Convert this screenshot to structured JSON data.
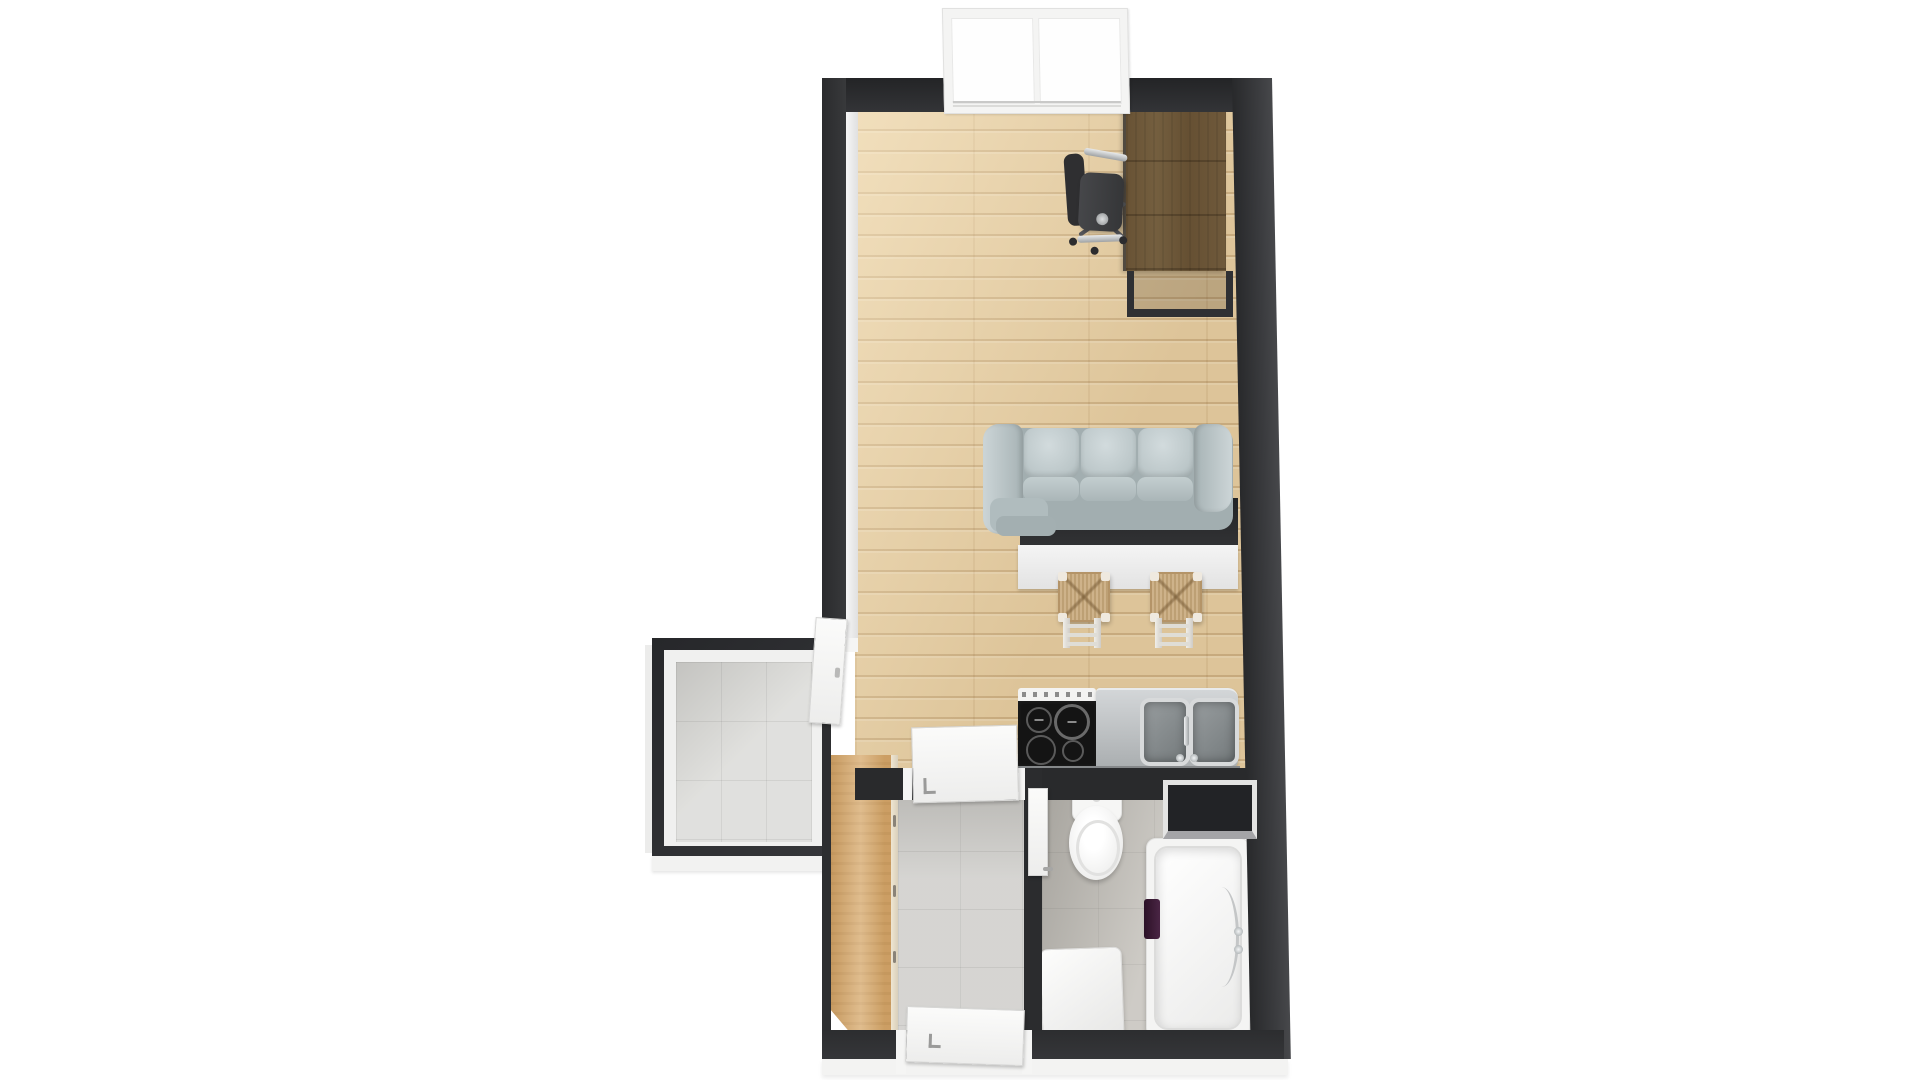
{
  "scene": {
    "type": "3d-floor-plan-render",
    "view": "top-down",
    "background": "#ffffff",
    "colors": {
      "wall": "#2e2f31",
      "wood-floor": "#e6cc9f",
      "tile-balcony": "#dcdcd9",
      "tile-hall": "#d2d1ce",
      "tile-bath": "#c8c5bf",
      "wood-desk": "#a69478",
      "wood-wardrobe": "#d7aa6e",
      "wood-stool": "#c7a87a",
      "sofa": "#bcc7c9",
      "steel": "#b7babc",
      "cooktop": "#141414",
      "fixture-white": "#f6f6f5",
      "accent-purple": "#4a2544",
      "chrome": "#cdd0d2"
    },
    "rooms": [
      {
        "id": "living-room",
        "floor": "light-oak-planks"
      },
      {
        "id": "kitchenette",
        "floor": "light-oak-planks"
      },
      {
        "id": "balcony-storage-room",
        "floor": "light-gray-tile"
      },
      {
        "id": "hallway",
        "floor": "gray-tile"
      },
      {
        "id": "bathroom",
        "floor": "beige-gray-tile"
      }
    ],
    "furniture": [
      {
        "id": "window",
        "room": "living-room",
        "style": "white-frame-two-panes"
      },
      {
        "id": "desk",
        "room": "living-room",
        "material": "rustic-wood-metal-frame"
      },
      {
        "id": "office-chair",
        "room": "living-room",
        "style": "dark-swivel-chrome-arms"
      },
      {
        "id": "sofa",
        "room": "living-room",
        "seats": 3,
        "color": "light-blue-gray"
      },
      {
        "id": "breakfast-bar",
        "room": "kitchenette",
        "top": "dark",
        "base": "white"
      },
      {
        "id": "bar-stool",
        "count": 2,
        "seat": "woven-rush",
        "legs": "white"
      },
      {
        "id": "stove",
        "room": "kitchenette",
        "burners": 4
      },
      {
        "id": "double-sink",
        "room": "kitchenette",
        "material": "stainless-steel"
      },
      {
        "id": "wardrobe",
        "room": "hallway",
        "material": "light-wood"
      },
      {
        "id": "toilet",
        "room": "bathroom"
      },
      {
        "id": "bathtub",
        "room": "bathroom",
        "accessory": "purple-towel"
      },
      {
        "id": "washing-machine",
        "room": "bathroom"
      },
      {
        "id": "wall-niche",
        "room": "bathroom"
      }
    ],
    "doors": [
      {
        "id": "door-living-to-hallway",
        "state": "open"
      },
      {
        "id": "door-entry",
        "state": "open"
      },
      {
        "id": "door-balcony",
        "state": "open"
      },
      {
        "id": "door-bathroom",
        "state": "open"
      }
    ]
  }
}
